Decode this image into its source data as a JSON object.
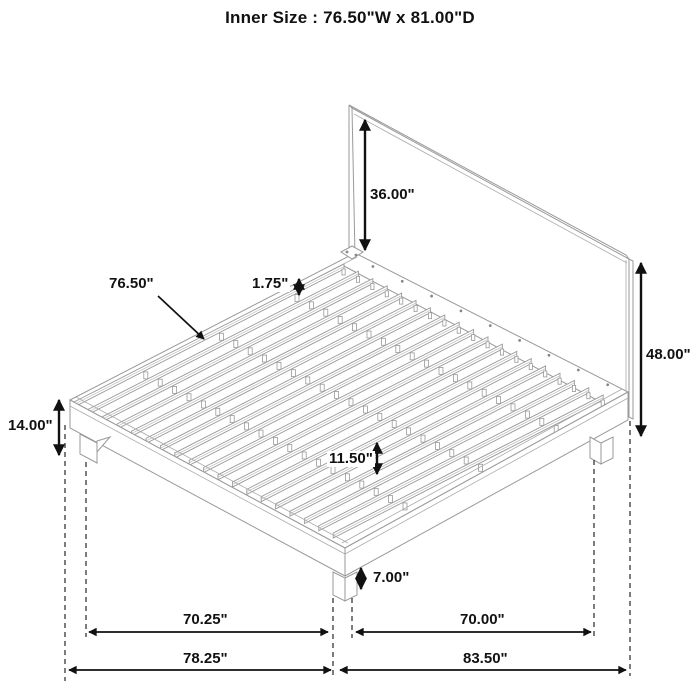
{
  "title": "Inner Size : 76.50\"W x 81.00\"D",
  "dims": {
    "headboard_panel_height": "36.00\"",
    "slat_length": "76.50\"",
    "slat_width": "1.75\"",
    "headboard_total_height": "48.00\"",
    "platform_surface_height": "14.00\"",
    "slat_support_spacing": "11.50\"",
    "leg_height": "7.00\"",
    "base_width_inner": "70.25\"",
    "base_depth_inner": "70.00\"",
    "base_width_outer": "78.25\"",
    "base_depth_outer": "83.50\""
  }
}
